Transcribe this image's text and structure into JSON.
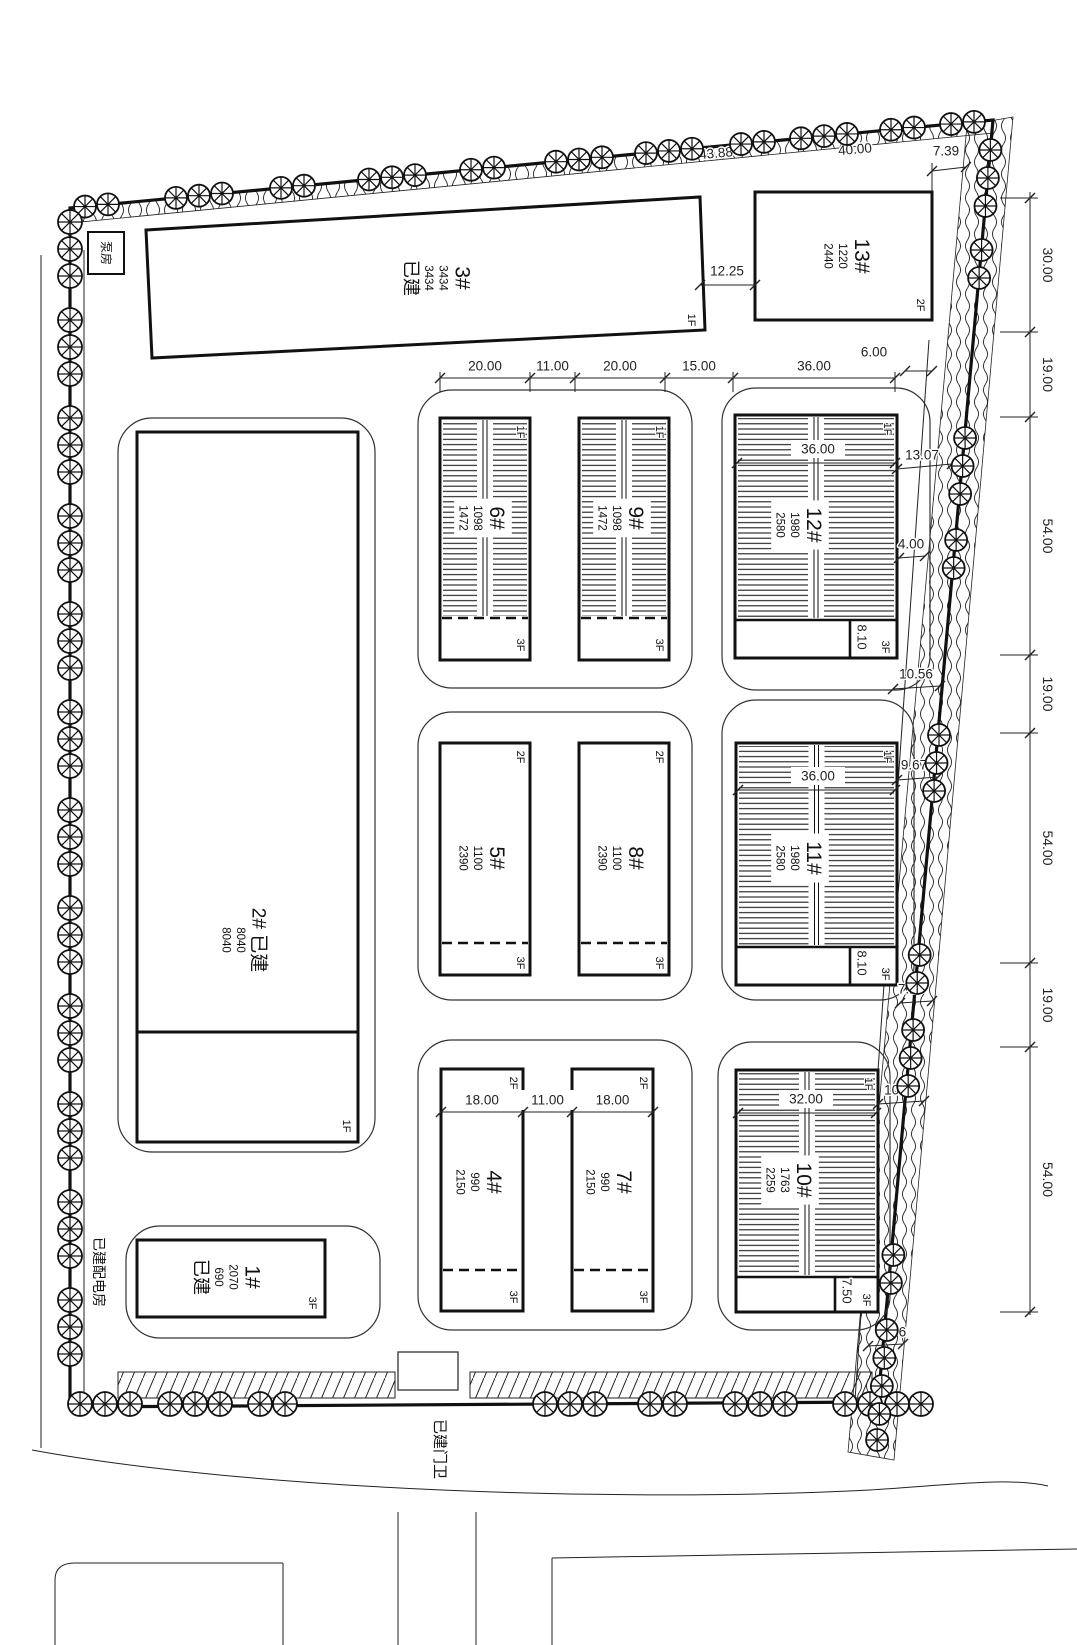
{
  "site_labels": {
    "pump_house": "泵房",
    "power_room": "已建配电房",
    "gate_house": "已建门卫"
  },
  "buildings": [
    {
      "name": "1#",
      "lines": [
        "1#",
        "2070",
        "690",
        "已建"
      ],
      "tag_bottom": "3F"
    },
    {
      "name": "2#",
      "lines": [
        "2#  已建",
        "8040",
        "8040"
      ],
      "tag_bottom": "1F"
    },
    {
      "name": "3#",
      "lines": [
        "3#",
        "3434",
        "3434",
        "已建"
      ],
      "tag_bottom": "1F"
    },
    {
      "name": "4#",
      "lines": [
        "4#",
        "990",
        "2150"
      ],
      "tag_top": "2F",
      "tag_bottom": "3F"
    },
    {
      "name": "5#",
      "lines": [
        "5#",
        "1100",
        "2390"
      ],
      "tag_top": "2F",
      "tag_bottom": "3F"
    },
    {
      "name": "6#",
      "lines": [
        "6#",
        "1098",
        "1472"
      ],
      "tag_top": "1F",
      "tag_bottom": "3F"
    },
    {
      "name": "7#",
      "lines": [
        "7#",
        "990",
        "2150"
      ],
      "tag_top": "2F",
      "tag_bottom": "3F"
    },
    {
      "name": "8#",
      "lines": [
        "8#",
        "1100",
        "2390"
      ],
      "tag_top": "2F",
      "tag_bottom": "3F"
    },
    {
      "name": "9#",
      "lines": [
        "9#",
        "1098",
        "1472"
      ],
      "tag_top": "1F",
      "tag_bottom": "3F"
    },
    {
      "name": "10#",
      "lines": [
        "10#",
        "1763",
        "2259"
      ],
      "tag_top": "1F",
      "tag_bottom": "3F",
      "strip_dim": "7.50",
      "inner_dim": "32.00"
    },
    {
      "name": "11#",
      "lines": [
        "11#",
        "1980",
        "2580"
      ],
      "tag_top": "1F",
      "tag_bottom": "3F",
      "strip_dim": "8.10",
      "inner_dim": "36.00"
    },
    {
      "name": "12#",
      "lines": [
        "12#",
        "1980",
        "2580"
      ],
      "tag_top": "1F",
      "tag_bottom": "3F",
      "strip_dim": "8.10",
      "inner_dim": "36.00"
    },
    {
      "name": "13#",
      "lines": [
        "13#",
        "1220",
        "2440"
      ],
      "tag_bottom": "2F"
    }
  ],
  "dimensions": {
    "top_chain": [
      "20.00",
      "11.00",
      "20.00",
      "15.00",
      "36.00"
    ],
    "row3_chain": [
      "18.00",
      "11.00",
      "18.00"
    ],
    "right_chain": [
      "30.00",
      "19.00",
      "54.00",
      "19.00",
      "54.00",
      "19.00",
      "54.00"
    ],
    "boundary_top": [
      "43.88",
      "40.00"
    ],
    "gaps": {
      "g13_side": "7.39",
      "g3_13": "12.25",
      "g12_top": "6.00",
      "g12_a": "13.07",
      "g12_b": "4.00",
      "g11_top": "10.56",
      "g11_a": "9.67",
      "g10_top": "7.16",
      "g10_a": "10.27",
      "g10_b": "7.76"
    }
  }
}
